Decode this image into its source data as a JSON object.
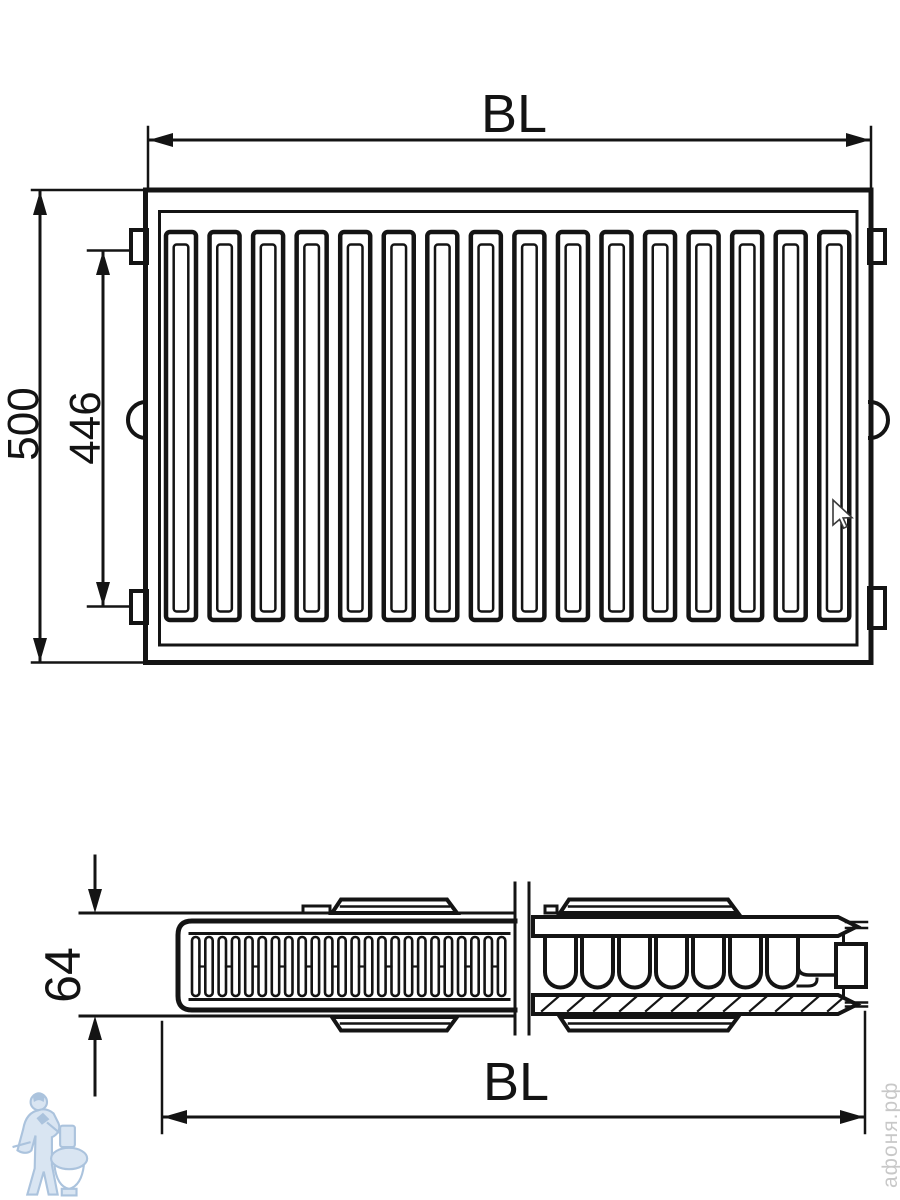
{
  "diagram": {
    "type": "technical-drawing",
    "subject": "steel panel radiator overall dimensions, front view and side section",
    "front_view": {
      "width_label": "BL",
      "height_label": "500",
      "mount_height_label": "446",
      "channel_count": 16
    },
    "side_view": {
      "depth_label": "64",
      "width_label": "BL",
      "left_fin_count": 24,
      "right_fin_count": 7,
      "hatch_count": 12
    },
    "watermark_text": "афоня.рф",
    "colors": {
      "line": "#141414",
      "background": "#ffffff",
      "watermark": "#c3c3c3",
      "logo_stroke": "#a7c0dc",
      "logo_fill": "#d7e4f2"
    }
  }
}
